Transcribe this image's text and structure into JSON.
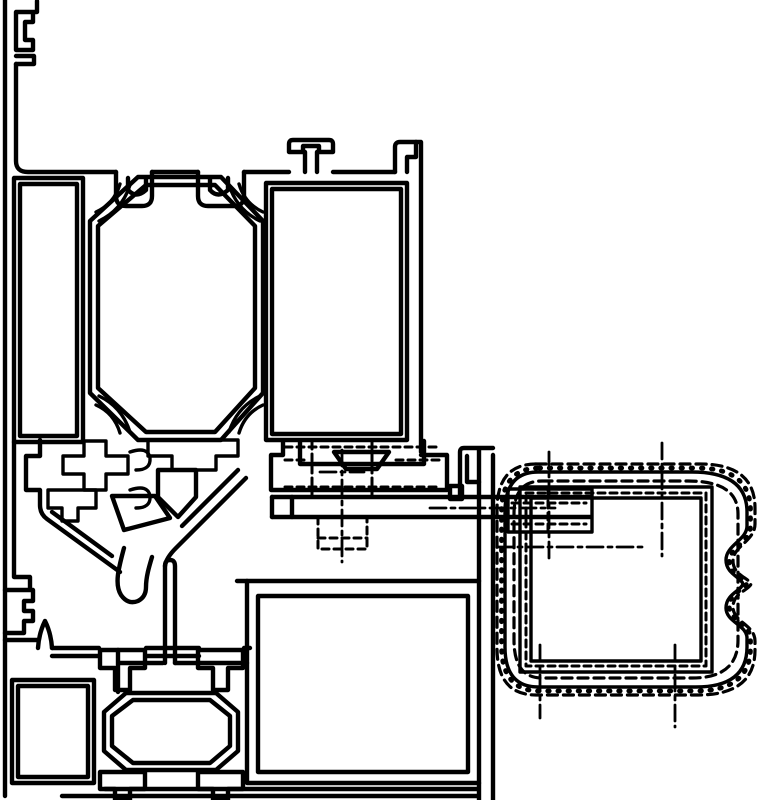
{
  "diagram": {
    "kind": "technical-cad-cross-section",
    "subject": "Aluminium door/window frame corner profile cross-section with hidden roller housing and screw fixing",
    "background_color": "#ffffff",
    "stroke_color": "#000000",
    "line_styles": {
      "visible_edges": "solid",
      "hidden_edges": "dashed",
      "centerlines": "dash-dot"
    },
    "components": [
      {
        "id": "outer-frame-wall",
        "label": "Outer frame wall with snap-fit clips",
        "style": "solid"
      },
      {
        "id": "main-profile",
        "label": "Main frame profile, top flange with T-stub and end hook",
        "style": "solid"
      },
      {
        "id": "left-chamber",
        "label": "Tall rectangular hollow chamber",
        "style": "solid"
      },
      {
        "id": "central-chamber",
        "label": "Octagonal hollow chamber with corner screw bosses",
        "style": "solid"
      },
      {
        "id": "right-chamber",
        "label": "Rectangular glazing chamber",
        "style": "solid"
      },
      {
        "id": "gasket-channels",
        "label": "Gasket / glazing-bead channels",
        "style": "solid"
      },
      {
        "id": "thermal-web",
        "label": "V-shaped web with triangular hollows and drainage leg",
        "style": "solid"
      },
      {
        "id": "glazing-foot",
        "label": "Stepped glazing support foot",
        "style": "solid"
      },
      {
        "id": "flat-bar",
        "label": "Horizontal fixing bar",
        "style": "solid"
      },
      {
        "id": "hook-clip",
        "label": "J-hook interlock and vertical twin bar",
        "style": "solid"
      },
      {
        "id": "bottom-profile",
        "label": "Lower threshold profile with horizontal octagonal chamber",
        "style": "solid"
      },
      {
        "id": "bottom-chamber",
        "label": "Large rectangular bottom chamber",
        "style": "solid"
      },
      {
        "id": "screw-fixing",
        "label": "Hidden screw fixing",
        "style": "dashed"
      },
      {
        "id": "roller-housing",
        "label": "Hidden roller / handle housing with finger-grip scallops",
        "style": "dashed"
      },
      {
        "id": "centerlines",
        "label": "Construction centerlines",
        "style": "dash-dot"
      }
    ]
  }
}
